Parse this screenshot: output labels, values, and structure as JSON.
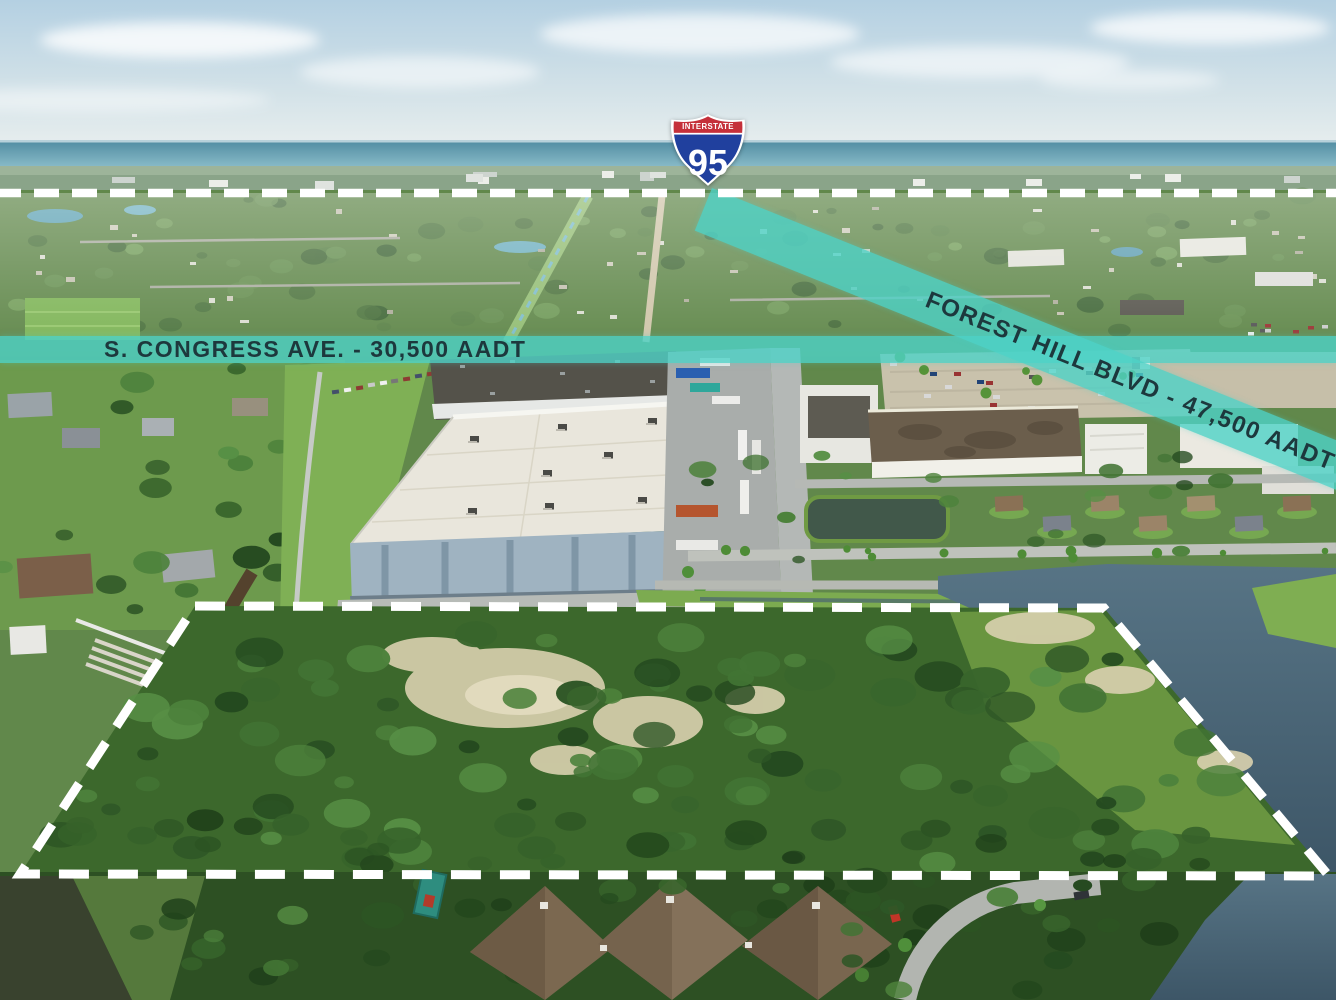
{
  "annotations": {
    "interstate_shield": {
      "header": "INTERSTATE",
      "route_number": "95"
    },
    "roads": [
      {
        "id": "s_congress_ave",
        "label": "S. CONGRESS AVE. - 30,500 AADT",
        "aadt": "30,500"
      },
      {
        "id": "forest_hill_blvd",
        "label": "FOREST HILL BLVD - 47,500 AADT",
        "aadt": "47,500"
      }
    ],
    "highway_line": {
      "style": "dashed",
      "color": "#ffffff"
    },
    "property_boundary": {
      "style": "dashed",
      "color": "#ffffff"
    }
  },
  "colors": {
    "road_band_teal": "#4dd2c7",
    "band_text": "#1d383d",
    "shield_red": "#c5303a",
    "shield_blue": "#20409e",
    "sky": "#bcd6e4",
    "ocean": "#6aa4b6"
  }
}
